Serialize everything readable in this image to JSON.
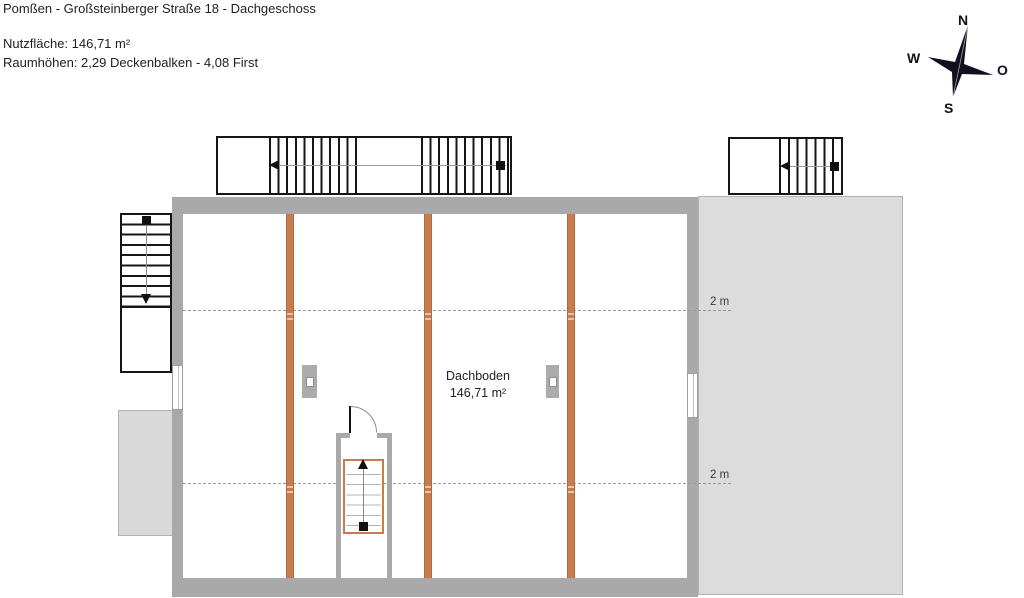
{
  "header": {
    "title": "Pomßen - Großsteinberger Straße 18 - Dachgeschoss",
    "area_line": "Nutzfläche: 146,71 m²",
    "heights_line": "Raumhöhen: 2,29 Deckenbalken - 4,08 First"
  },
  "plan": {
    "room": {
      "name": "Dachboden",
      "area": "146,71 m²"
    },
    "height_markers": [
      {
        "label": "2 m"
      },
      {
        "label": "2 m"
      }
    ]
  },
  "compass": {
    "north": "N",
    "west": "W",
    "east": "O",
    "south": "S"
  },
  "colors": {
    "beam_orange": "#c87c4e",
    "wall_gray": "#a9a9a9",
    "light_area_gray": "#dcdcdc",
    "stair_outline": "#161616"
  }
}
